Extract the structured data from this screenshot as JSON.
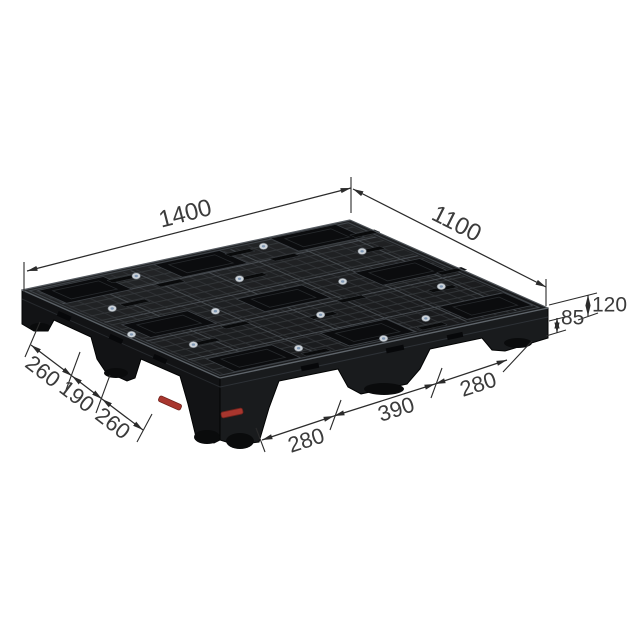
{
  "diagram": {
    "dims": {
      "length_top": "1400",
      "width_top": "1100",
      "under_deck_height": "85",
      "total_height": "120",
      "side_segments": [
        "260",
        "190",
        "260"
      ],
      "front_segments": [
        "280",
        "390",
        "280"
      ]
    },
    "colors": {
      "background": "#ffffff",
      "dimension_line": "#2b2b2b",
      "label_text": "#3b3b3b",
      "pallet_body": "#1a1c1e",
      "pallet_wall_left": "#121315",
      "pallet_wall_right": "#191b1d",
      "pallet_mesh": "#3a3e42",
      "pocket": "#0b0c0e",
      "rivet": "#ccd2d8",
      "rivet_center": "#7e96b2",
      "tag_red": "#a8362e"
    }
  }
}
